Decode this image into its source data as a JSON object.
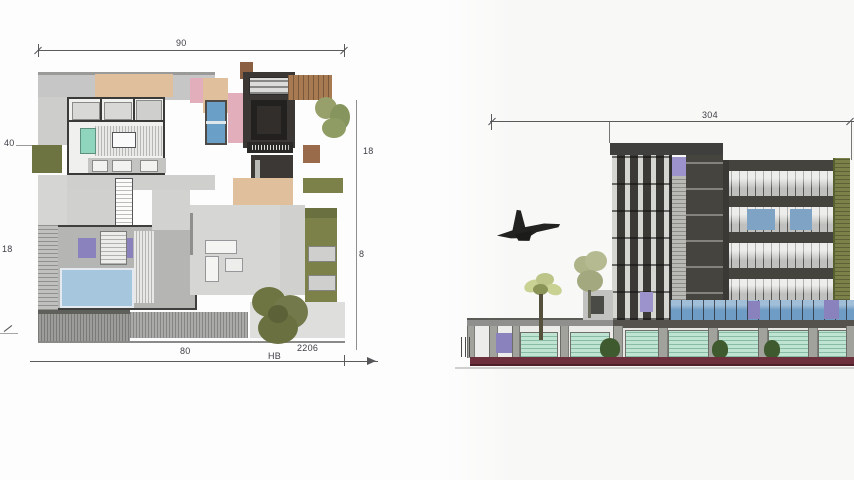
{
  "page": {
    "title": "Modern villa floor plan and street elevation drawing"
  },
  "palette": {
    "wall_dark": "#3a3a38",
    "floor_gray": "#d6d6d6",
    "tan": "#e0bf9d",
    "pink": "#e3aebc",
    "pool_blue": "#a6c6de",
    "window_blue": "#6aa0c8",
    "teal": "#8fd4bd",
    "purple": "#8a82bd",
    "lavender": "#9c92cc",
    "olive": "#7b8148",
    "leaf_green": "#97a06a",
    "wood_brown": "#a87a52",
    "mint_glass": "#bfe4d2",
    "glass_blue": "#6f9cc4",
    "base_maroon": "#6e2f3c",
    "facade_dark": "#46443f",
    "facade_light": "#c9c9c6",
    "tree_dark": "#3e5a2e",
    "palm_green": "#c9d193"
  },
  "floor_plan": {
    "dim_top": "90",
    "dim_left_upper": "40",
    "dim_left_lower": "18",
    "dim_right_upper": "18",
    "dim_right_lower": "8",
    "dim_bottom": "80",
    "note_hb": "HB",
    "note_code": "2206"
  },
  "elevation": {
    "dim_top": "304"
  }
}
